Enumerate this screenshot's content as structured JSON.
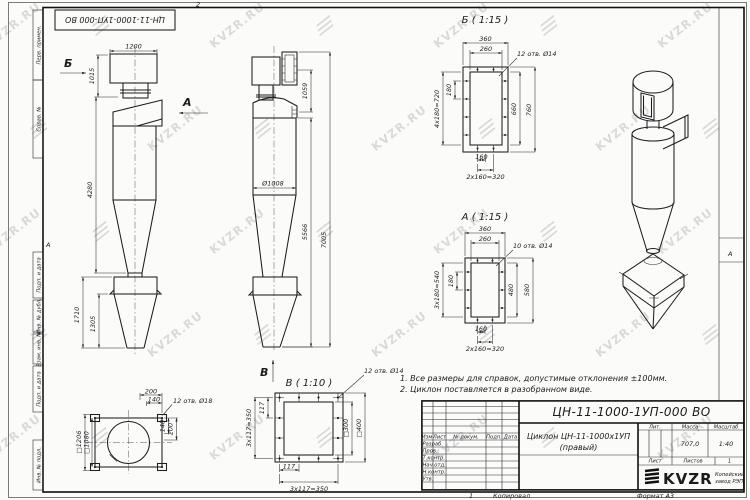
{
  "watermark": {
    "text": "KVZR.RU"
  },
  "frame": {
    "stamp": "ЦН-11-1000-1УП-000 ВО",
    "left_labels": [
      "Перв. примен.",
      "Справ. №",
      "Подп. и дата",
      "Инв. № дубл.",
      "Взам. инв. №",
      "Подп. и дата",
      "Инв. № подл."
    ],
    "zone_letter_left": "А",
    "zone_letter_right": "А",
    "zone_number_top": "2",
    "bottom_sheet_number": "1",
    "copied_by_label": "Копировал",
    "format_label": "Формат А3"
  },
  "notes": {
    "line1": "1. Все размеры для справок, допустимые отклонения ±100мм.",
    "line2": "2. Циклон поставляется в разобранном виде."
  },
  "front_view": {
    "dim_1200": "1200",
    "label_b": "Б",
    "dim_1015": "1015",
    "label_a": "А",
    "dim_4280": "4280",
    "dim_1710": "1710",
    "dim_1305": "1305"
  },
  "side_view": {
    "dim_1059": "1059",
    "dim_d1008": "Ø1008",
    "dim_5566": "5566",
    "dim_7005": "7005",
    "label_v": "В"
  },
  "section_b": {
    "title": "Б ( 1:15 )",
    "dim_360": "360",
    "dim_260": "260",
    "holes": "12 отв. Ø14",
    "dim_180": "180",
    "dim_4x180": "4х180=720",
    "dim_660": "660",
    "dim_760": "760",
    "dim_160": "160",
    "dim_2x160": "2х160=320"
  },
  "section_a": {
    "title": "А ( 1:15 )",
    "dim_360": "360",
    "dim_260": "260",
    "holes": "10 отв. Ø14",
    "dim_180": "180",
    "dim_3x180": "3х180=540",
    "dim_480": "480",
    "dim_580": "580",
    "dim_160": "160",
    "dim_2x160": "2х160=320"
  },
  "plan_view": {
    "dim_200": "200",
    "dim_140": "140",
    "holes": "12 отв. Ø18",
    "dim_sq1206": "□1206",
    "dim_sq1080": "□1080",
    "dim_140r": "140",
    "dim_200r": "200"
  },
  "section_v": {
    "title": "В ( 1:10 )",
    "holes": "12 отв. Ø14",
    "dim_117": "117",
    "dim_3x117": "3х117=350",
    "dim_sq300": "□300",
    "dim_sq400": "□400",
    "dim_117b": "117",
    "dim_3x117b": "3х117=350"
  },
  "title_block": {
    "doc_number": "ЦН-11-1000-1УП-000 ВО",
    "name_line1": "Циклон ЦН-11-1000х1УП",
    "name_line2": "(правый)",
    "header_cols": [
      "Изм",
      "Лист",
      "№ докум.",
      "Подп.",
      "Дата"
    ],
    "row_labels": [
      "Разраб.",
      "Пров.",
      "Т.контр.",
      "Нач.отд.",
      "Н.контр.",
      "Утв."
    ],
    "lit_label": "Лит.",
    "mass_label": "Масса",
    "scale_label": "Масштаб",
    "mass_value": "707,0",
    "scale_value": "1:40",
    "sheet_label": "Лист",
    "sheets_label": "Листов",
    "sheets_value": "1",
    "logo_text": "KVZR",
    "company_line1": "Копейский",
    "company_line2": "завод РЭП"
  }
}
